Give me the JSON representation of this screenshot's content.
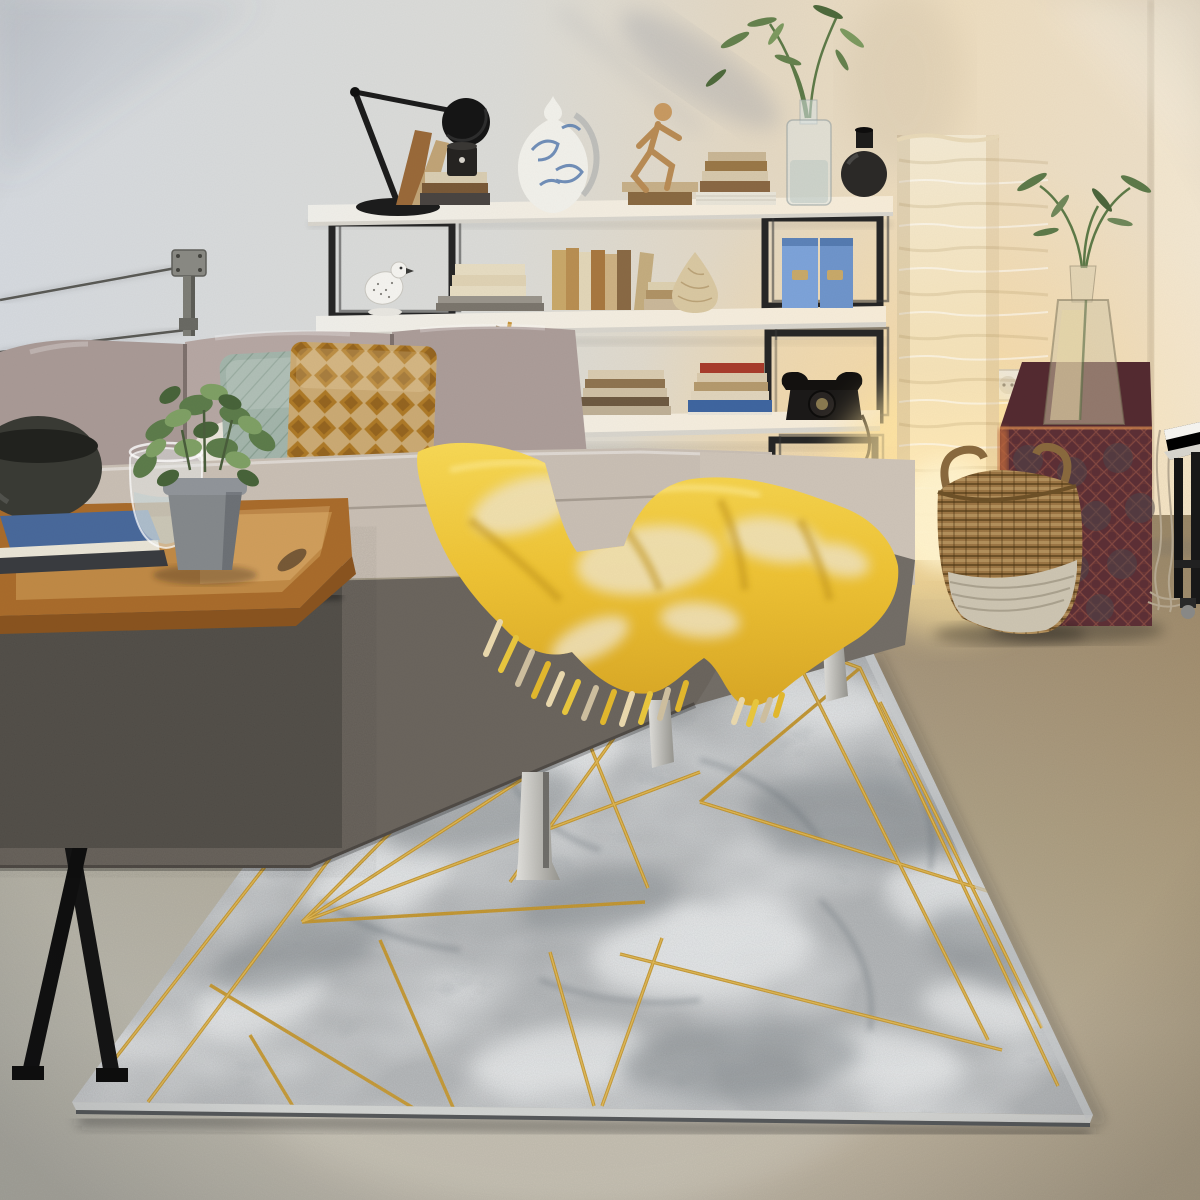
{
  "meta": {
    "type": "photograph",
    "description": "Living room product scene: grey marble-effect area rug with gold geometric lines, corner sofa with yellow mohair throw, white shelving with black steel cubes, glowing paper floor lamp, maroon cane-weave pouf and wicker baskets on a concrete floor",
    "width": 1200,
    "height": 1200
  },
  "palette": {
    "wall_cool": "#d5d9de",
    "wall_mid": "#dbdbd7",
    "wall_warm": "#e3d8c4",
    "wall_peach": "#edddc0",
    "wall_edge": "#ecdfc9",
    "glow_core": "#fff3cd",
    "glow_warm": "#ffe4a0",
    "floor_far": "#9d9077",
    "floor_mid": "#b3a993",
    "floor_near": "#c0b9a9",
    "floor_light": "#d2ccc0",
    "rug_base": "#b6b9bb",
    "rug_light": "#e9ebec",
    "rug_dark": "#878d91",
    "rug_vein": "#667077",
    "rug_gold": "#c9992e",
    "rug_gold_hi": "#e9c05a",
    "shelf_white": "#efeee9",
    "shelf_warm": "#f7ecd8",
    "frame_black": "#272727",
    "sofa_back": "#ac9d99",
    "sofa_back_hi": "#b6a7a3",
    "sofa_seat": "#c9bfb4",
    "sofa_chaise": "#cec4b8",
    "sofa_base": "#6b655e",
    "metal_hi": "#e2e1dd",
    "metal_lo": "#979690",
    "pillow_teal": "#b2c5ba",
    "pillow_mustard_bg": "#e0c48c",
    "pillow_mustard_dia": "#c08c30",
    "pillow_white": "#e9e4da",
    "blanket_hi": "#f7d855",
    "blanket_mid": "#eec335",
    "blanket_lo": "#d9a826",
    "blanket_cream": "#efe2c0",
    "tray_wood": "#a96c2c",
    "tray_floor": "#c08a46",
    "tray_face": "#8a5420",
    "table_fabric": "#56524c",
    "leg_black": "#151515",
    "pot_grey": "#85898c",
    "plant_green": "#5d7c4b",
    "plant_light": "#7fa065",
    "plant_dark": "#48643a",
    "book_blue": "#49699b",
    "book_red": "#a83c2c",
    "book_tan": "#b98f52",
    "book_cream": "#e6dcc2",
    "vase_white": "#f1f0ea",
    "vase_blue": "#5b7fb0",
    "vase_black": "#2c2a28",
    "vase_twist": "#d9c8a2",
    "file_blue": "#7da3d9",
    "phone_black": "#1c1a19",
    "box_black": "#151312",
    "gold_accent": "#b59440",
    "wick_dark": "#8a6a3c",
    "wick_light": "#a8854f",
    "basket_pale": "#cdc5b2",
    "lamp_top": "#f3e9d2",
    "lamp_mid": "#f5e2b8",
    "lamp_low": "#ffe9b6",
    "lamp_bright": "#fff0c4",
    "lamp_wood": "#9a6c3a",
    "pouf_front": "#5d3036",
    "pouf_top": "#542b31",
    "pouf_lattice": "#8f4e44",
    "pouf_rim": "#c06a3c",
    "bracket_metal": "#8a8a84",
    "cable": "#5a5a55",
    "socket": "#efe9dc"
  },
  "scene": {
    "objects": [
      "marble-gold-rug",
      "corner-sofa",
      "yellow-mohair-throw",
      "white-shelving-unit",
      "black-steel-cube-frames",
      "architect-desk-lamp",
      "blue-white-ceramic-vase",
      "wooden-mannequin",
      "bird-figurine",
      "bamboo-in-glass-bottle",
      "black-gourd-vase",
      "twisted-cream-vase",
      "blue-magazine-files",
      "vintage-telephone",
      "black-lacquer-box",
      "woven-tray-basket",
      "book-stacks",
      "paper-floor-lamp",
      "maroon-cane-pouf",
      "glass-flask-vase",
      "wicker-basket-two-tone",
      "small-wicker-basket",
      "wooden-serving-tray-table",
      "potted-green-plant",
      "water-glass",
      "black-bowl",
      "blue-book",
      "teal-quilted-pillow",
      "mustard-lattice-pillow",
      "wall-cable-bracket",
      "wall-socket",
      "white-side-table",
      "concrete-floor"
    ]
  }
}
